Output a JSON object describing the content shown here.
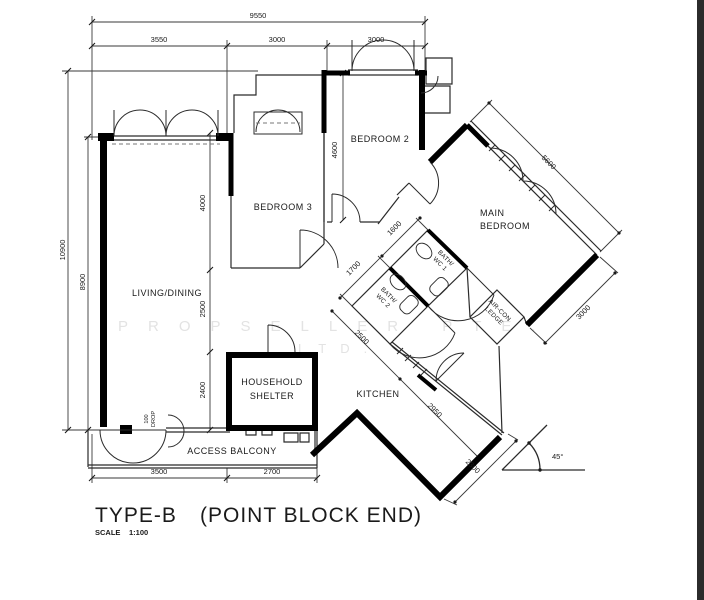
{
  "title": {
    "type_label": "TYPE-B",
    "variant_label": "(POINT BLOCK END)",
    "scale_label": "SCALE",
    "scale_value": "1:100"
  },
  "watermark": {
    "line1": "PROPSELLER PTE.",
    "line2": "LTD."
  },
  "rooms": {
    "living": "LIVING/DINING",
    "bedroom3": "BEDROOM 3",
    "bedroom2": "BEDROOM 2",
    "main_bedroom_line1": "MAIN",
    "main_bedroom_line2": "BEDROOM",
    "bath1_line1": "BATH/",
    "bath1_line2": "WC 1",
    "bath2_line1": "BATH/",
    "bath2_line2": "WC 2",
    "kitchen": "KITCHEN",
    "shelter_line1": "HOUSEHOLD",
    "shelter_line2": "SHELTER",
    "balcony": "ACCESS BALCONY",
    "aircon_line1": "AIR-CON",
    "aircon_line2": "LEDGE"
  },
  "dims": {
    "overall_width": "9550",
    "living_width": "3550",
    "bedroom3_width": "3000",
    "bedroom2_width": "3000",
    "overall_height": "10900",
    "living_height": "8900",
    "bedroom2_depth": "4600",
    "bedroom3_depth": "4000",
    "hall_depth": "2500",
    "shelter_depth": "2400",
    "balcony_left": "3500",
    "balcony_right": "2700",
    "main_bedroom_width": "5600",
    "main_bedroom_depth": "3000",
    "bath1_width": "1600",
    "bath2_width": "1700",
    "kitchen_upper": "2500",
    "kitchen_width": "2950",
    "kitchen_lower": "2300"
  },
  "annotations": {
    "drop_value": "100",
    "drop_word": "DROP",
    "angle": "45°"
  }
}
